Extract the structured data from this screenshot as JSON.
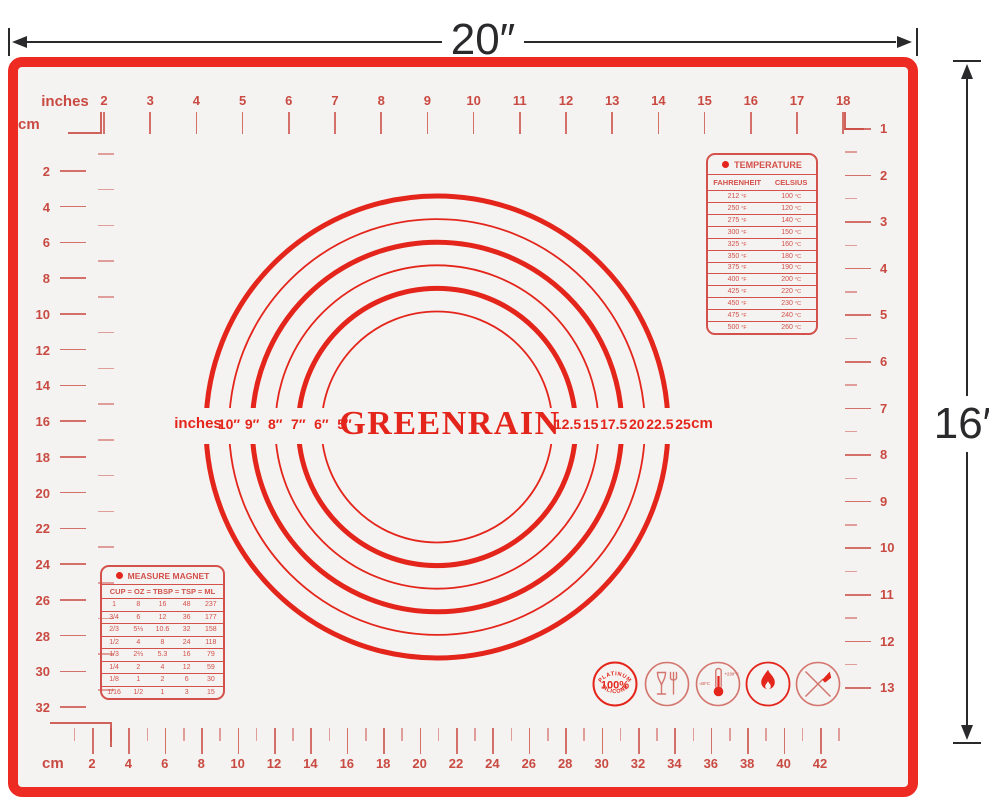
{
  "colors": {
    "frame_red": "#ee2b22",
    "bright_red": "#e4251b",
    "marking_red": "#c94a42",
    "table_red": "#d4504a",
    "soft_red": "#d4766e",
    "mat_bg": "#f4f3f1",
    "dim_black": "#2a2a2c"
  },
  "dimension_labels": {
    "width": "20″",
    "height": "16″"
  },
  "brand": "GREENRAIN",
  "rulers": {
    "top": {
      "unit_label": "inches",
      "labels": [
        "2",
        "3",
        "4",
        "5",
        "6",
        "7",
        "8",
        "9",
        "10",
        "11",
        "12",
        "13",
        "14",
        "15",
        "16",
        "17",
        "18"
      ]
    },
    "left": {
      "unit_label": "cm",
      "labels": [
        "2",
        "4",
        "6",
        "8",
        "10",
        "12",
        "14",
        "16",
        "18",
        "20",
        "22",
        "24",
        "26",
        "28",
        "30",
        "32"
      ]
    },
    "right": {
      "labels": [
        "1",
        "2",
        "3",
        "4",
        "5",
        "6",
        "7",
        "8",
        "9",
        "10",
        "11",
        "12",
        "13"
      ]
    },
    "bottom": {
      "unit_label": "cm",
      "labels": [
        "2",
        "4",
        "6",
        "8",
        "10",
        "12",
        "14",
        "16",
        "18",
        "20",
        "22",
        "24",
        "26",
        "28",
        "30",
        "32",
        "34",
        "36",
        "38",
        "40",
        "42"
      ]
    }
  },
  "circle_gauge": {
    "left_unit_label": "inches",
    "inch_labels": [
      "10″",
      "9″",
      "8″",
      "7″",
      "6″",
      "5″"
    ],
    "cm_labels": [
      "12.5",
      "15",
      "17.5",
      "20",
      "22.5",
      "25"
    ],
    "right_unit_label": "cm",
    "diameters_in": [
      5,
      6,
      7,
      8,
      9,
      10
    ]
  },
  "temperature_table": {
    "title": "TEMPERATURE",
    "columns": [
      "FAHRENHEIT",
      "CELSIUS"
    ],
    "unit_f": "°F",
    "unit_c": "°C",
    "rows": [
      [
        "212",
        "100"
      ],
      [
        "250",
        "120"
      ],
      [
        "275",
        "140"
      ],
      [
        "300",
        "150"
      ],
      [
        "325",
        "160"
      ],
      [
        "350",
        "180"
      ],
      [
        "375",
        "190"
      ],
      [
        "400",
        "200"
      ],
      [
        "425",
        "220"
      ],
      [
        "450",
        "230"
      ],
      [
        "475",
        "240"
      ],
      [
        "500",
        "260"
      ]
    ]
  },
  "measure_table": {
    "title": "MEASURE MAGNET",
    "columns": [
      "CUP",
      "OZ",
      "TBSP",
      "TSP",
      "ML"
    ],
    "separator": "=",
    "rows": [
      [
        "1",
        "8",
        "16",
        "48",
        "237"
      ],
      [
        "3/4",
        "6",
        "12",
        "36",
        "177"
      ],
      [
        "2/3",
        "5⅓",
        "10.6",
        "32",
        "158"
      ],
      [
        "1/2",
        "4",
        "8",
        "24",
        "118"
      ],
      [
        "1/3",
        "2⅔",
        "5.3",
        "16",
        "79"
      ],
      [
        "1/4",
        "2",
        "4",
        "12",
        "59"
      ],
      [
        "1/8",
        "1",
        "2",
        "6",
        "30"
      ],
      [
        "1/16",
        "1/2",
        "1",
        "3",
        "15"
      ]
    ]
  },
  "badges": {
    "silicone": {
      "arc_top": "PLATINUM",
      "center": "100%",
      "arc_bottom": "SILICONE"
    },
    "thermometer": {
      "min": "-40°C",
      "max": "+230°C"
    },
    "icon_names": [
      "platinum-silicone-badge",
      "food-safe-glass-fork-icon",
      "temperature-range-icon",
      "heat-resistant-flame-icon",
      "no-knife-icon"
    ]
  }
}
